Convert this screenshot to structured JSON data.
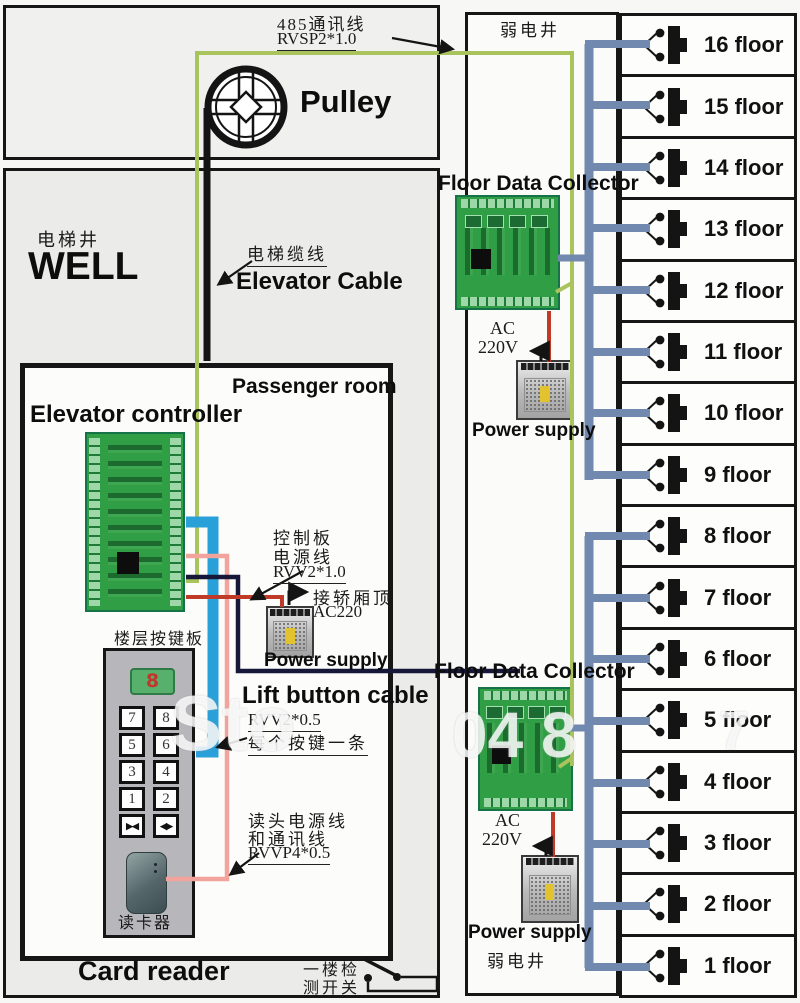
{
  "top": {
    "comm_label_l1": "485通讯线",
    "comm_label_l2": "RVSP2*1.0",
    "pulley": "Pulley"
  },
  "well": {
    "cn": "电梯井",
    "en": "WELL",
    "cable_cn": "电梯缆线",
    "cable_en": "Elevator Cable"
  },
  "passenger": {
    "title": "Passenger room",
    "controller_title": "Elevator controller",
    "control_power_l1": "控制板",
    "control_power_l2": "电源线",
    "control_power_l3": "RVV2*1.0",
    "car_top_l1": "接轿厢顶",
    "car_top_l2": "AC220",
    "power_supply": "Power supply",
    "lift_button_cable": "Lift button cable",
    "lift_spec": "RVV2*0.5",
    "lift_note": "每个按键一条",
    "keypad_label": "楼层按键板",
    "display_value": "8",
    "keys": [
      "7",
      "8",
      "5",
      "6",
      "3",
      "4",
      "1",
      "2",
      "▶◀",
      "◀▶"
    ],
    "reader_cable_l1": "读头电源线",
    "reader_cable_l2": "和通讯线",
    "reader_cable_l3": "RVVP4*0.5",
    "card_reader_cn": "读卡器",
    "card_reader_en": "Card reader",
    "floor_switch_l1": "一楼检",
    "floor_switch_l2": "测开关"
  },
  "riser": {
    "well_top": "弱电井",
    "well_bottom": "弱电井",
    "collector1_title": "Floor Data Collector",
    "collector2_title": "Floor Data Collector",
    "ac1_l1": "AC",
    "ac1_l2": "220V",
    "ac2_l1": "AC",
    "ac2_l2": "220V",
    "ps1": "Power supply",
    "ps2": "Power supply"
  },
  "floors": [
    "16 floor",
    "15 floor",
    "14 floor",
    "13 floor",
    "12 floor",
    "11 floor",
    "10 floor",
    "9 floor",
    "8 floor",
    "7 floor",
    "6 floor",
    "5 floor",
    "4 floor",
    "3 floor",
    "2 floor",
    "1 floor"
  ],
  "watermark": {
    "wm1": "Sto",
    "wm2": "04 8",
    "wm3": "7"
  },
  "colors": {
    "wire-green": "#a9c45c",
    "wire-bus": "#7189ae",
    "wire-blue": "#2aa0d8",
    "wire-pink": "#f2a49c",
    "wire-navy": "#17173a",
    "wire-red": "#c03a28",
    "pcb": "#2f9e44",
    "pcb-light": "#9ed8a8"
  }
}
